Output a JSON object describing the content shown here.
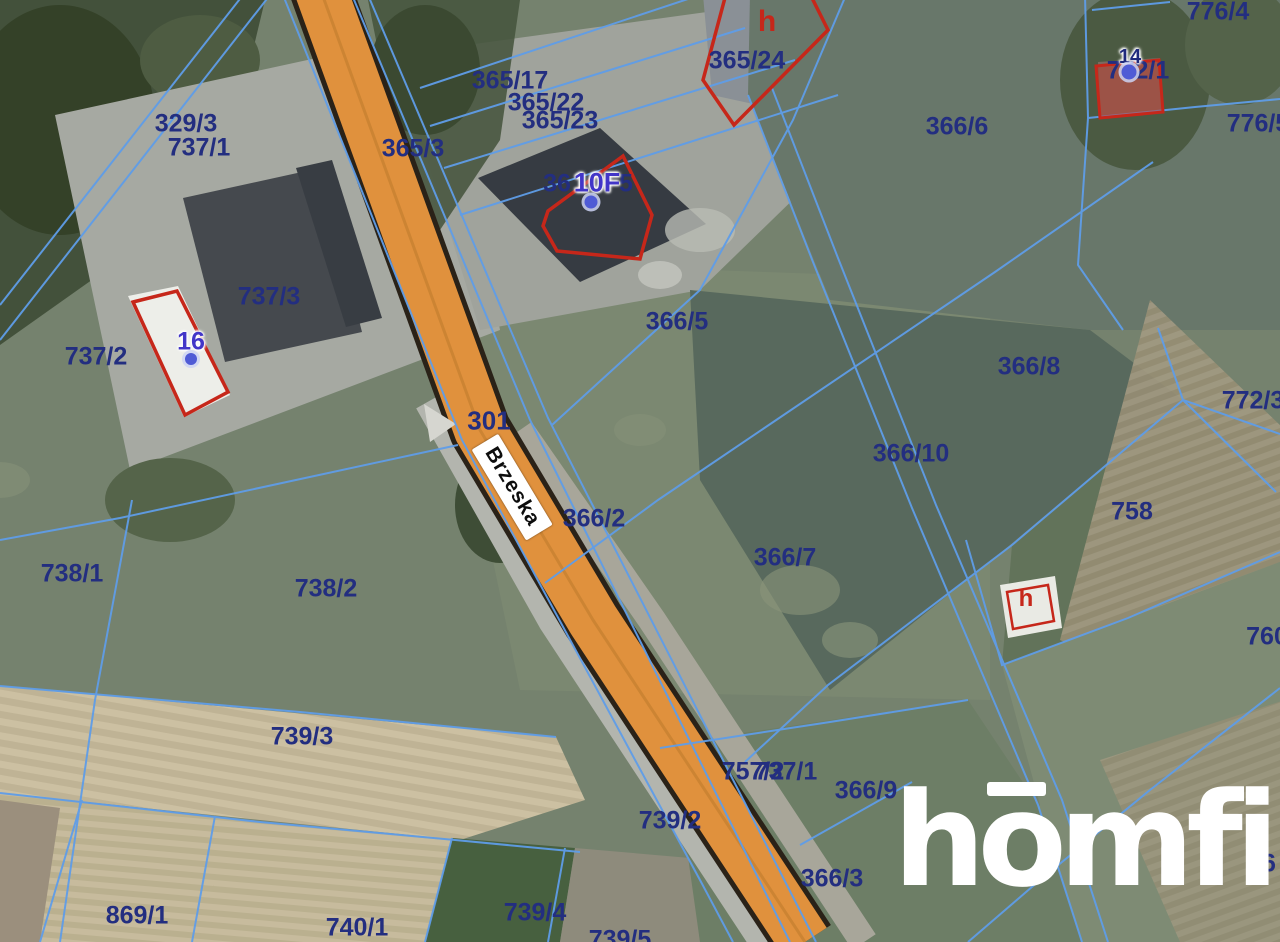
{
  "road": {
    "name": "Brzeska",
    "route_number": "301",
    "surface_color": "#e0913d"
  },
  "logo": {
    "part1": "h",
    "part2": "o",
    "part3": "mfi",
    "full_text": "homfi",
    "color": "#ffffff"
  },
  "colors": {
    "parcel_label": "#232e80",
    "parcel_line": "#5f9de8",
    "building_outline": "#c6271a",
    "address_label_blue": "#4236c8",
    "address_point": "#4f5bd5"
  },
  "map_labels": [
    {
      "text": "329/3",
      "x": 186,
      "y": 124,
      "type": "parcel",
      "name": "parcel-label-329-3"
    },
    {
      "text": "737/1",
      "x": 199,
      "y": 148,
      "type": "parcel",
      "name": "parcel-label-737-1"
    },
    {
      "text": "365/17",
      "x": 510,
      "y": 81,
      "type": "parcel",
      "name": "parcel-label-365-17"
    },
    {
      "text": "365/22",
      "x": 546,
      "y": 103,
      "type": "parcel",
      "name": "parcel-label-365-22"
    },
    {
      "text": "365/23",
      "x": 560,
      "y": 121,
      "type": "parcel",
      "name": "parcel-label-365-23"
    },
    {
      "text": "365/3",
      "x": 413,
      "y": 149,
      "type": "parcel",
      "name": "parcel-label-365-3"
    },
    {
      "text": "365/24",
      "x": 747,
      "y": 61,
      "type": "parcel",
      "name": "parcel-label-365-24"
    },
    {
      "text": "366/6",
      "x": 957,
      "y": 127,
      "type": "parcel",
      "name": "parcel-label-366-6"
    },
    {
      "text": "776/4",
      "x": 1218,
      "y": 12,
      "type": "parcel",
      "name": "parcel-label-776-4"
    },
    {
      "text": "776/5",
      "x": 1258,
      "y": 124,
      "type": "parcel",
      "name": "parcel-label-776-5"
    },
    {
      "text": "772/1",
      "x": 1138,
      "y": 71,
      "type": "parcel",
      "name": "parcel-label-772-1"
    },
    {
      "text": "36",
      "x": 557,
      "y": 184,
      "type": "parcel",
      "name": "parcel-label-fragment-36"
    },
    {
      "text": "5",
      "x": 626,
      "y": 184,
      "type": "parcel",
      "name": "parcel-label-fragment-5"
    },
    {
      "text": "737/3",
      "x": 269,
      "y": 297,
      "type": "parcel",
      "name": "parcel-label-737-3"
    },
    {
      "text": "737/2",
      "x": 96,
      "y": 357,
      "type": "parcel",
      "name": "parcel-label-737-2"
    },
    {
      "text": "366/5",
      "x": 677,
      "y": 322,
      "type": "parcel",
      "name": "parcel-label-366-5"
    },
    {
      "text": "366/8",
      "x": 1029,
      "y": 367,
      "type": "parcel",
      "name": "parcel-label-366-8"
    },
    {
      "text": "772/3",
      "x": 1253,
      "y": 401,
      "type": "parcel",
      "name": "parcel-label-772-3"
    },
    {
      "text": "366/10",
      "x": 911,
      "y": 454,
      "type": "parcel",
      "name": "parcel-label-366-10"
    },
    {
      "text": "758",
      "x": 1132,
      "y": 512,
      "type": "parcel",
      "name": "parcel-label-758"
    },
    {
      "text": "366/2",
      "x": 594,
      "y": 519,
      "type": "parcel",
      "name": "parcel-label-366-2"
    },
    {
      "text": "366/7",
      "x": 785,
      "y": 558,
      "type": "parcel",
      "name": "parcel-label-366-7"
    },
    {
      "text": "738/1",
      "x": 72,
      "y": 574,
      "type": "parcel",
      "name": "parcel-label-738-1"
    },
    {
      "text": "738/2",
      "x": 326,
      "y": 589,
      "type": "parcel",
      "name": "parcel-label-738-2"
    },
    {
      "text": "760",
      "x": 1267,
      "y": 637,
      "type": "parcel",
      "name": "parcel-label-760"
    },
    {
      "text": "739/3",
      "x": 302,
      "y": 737,
      "type": "parcel",
      "name": "parcel-label-739-3"
    },
    {
      "text": "757/2",
      "x": 753,
      "y": 772,
      "type": "parcel",
      "name": "parcel-label-757-2"
    },
    {
      "text": "737/1",
      "x": 786,
      "y": 772,
      "type": "parcel",
      "name": "parcel-label-737-1b"
    },
    {
      "text": "366/9",
      "x": 866,
      "y": 791,
      "type": "parcel",
      "name": "parcel-label-366-9"
    },
    {
      "text": "739/2",
      "x": 670,
      "y": 821,
      "type": "parcel",
      "name": "parcel-label-739-2"
    },
    {
      "text": "366/3",
      "x": 832,
      "y": 879,
      "type": "parcel",
      "name": "parcel-label-366-3"
    },
    {
      "text": "9",
      "x": 1048,
      "y": 848,
      "type": "parcel",
      "name": "parcel-label-fragment-9"
    },
    {
      "text": "46",
      "x": 1262,
      "y": 864,
      "type": "parcel",
      "name": "parcel-label-fragment-46"
    },
    {
      "text": "869/1",
      "x": 137,
      "y": 916,
      "type": "parcel",
      "name": "parcel-label-869-1"
    },
    {
      "text": "740/1",
      "x": 357,
      "y": 928,
      "type": "parcel",
      "name": "parcel-label-740-1"
    },
    {
      "text": "739/4",
      "x": 535,
      "y": 913,
      "type": "parcel",
      "name": "parcel-label-739-4"
    },
    {
      "text": "739/5",
      "x": 620,
      "y": 940,
      "type": "parcel",
      "name": "parcel-label-739-5"
    },
    {
      "text": "10F",
      "x": 597,
      "y": 183,
      "type": "address",
      "size": 27,
      "name": "address-label-10F"
    },
    {
      "text": "16",
      "x": 191,
      "y": 342,
      "type": "address",
      "size": 25,
      "name": "address-label-16"
    },
    {
      "text": "14",
      "x": 1130,
      "y": 57,
      "type": "address-dark",
      "size": 20,
      "name": "address-label-14"
    },
    {
      "text": "h",
      "x": 767,
      "y": 22,
      "type": "address-red",
      "size": 30,
      "name": "building-label-h-top"
    },
    {
      "text": "h",
      "x": 1026,
      "y": 599,
      "type": "address-red",
      "size": 24,
      "name": "building-label-h-small"
    }
  ],
  "address_points": [
    {
      "x": 591,
      "y": 202,
      "r": 13,
      "name": "address-point-10F"
    },
    {
      "x": 191,
      "y": 359,
      "r": 12,
      "name": "address-point-16"
    },
    {
      "x": 1129,
      "y": 72,
      "r": 15,
      "name": "address-point-14"
    }
  ]
}
